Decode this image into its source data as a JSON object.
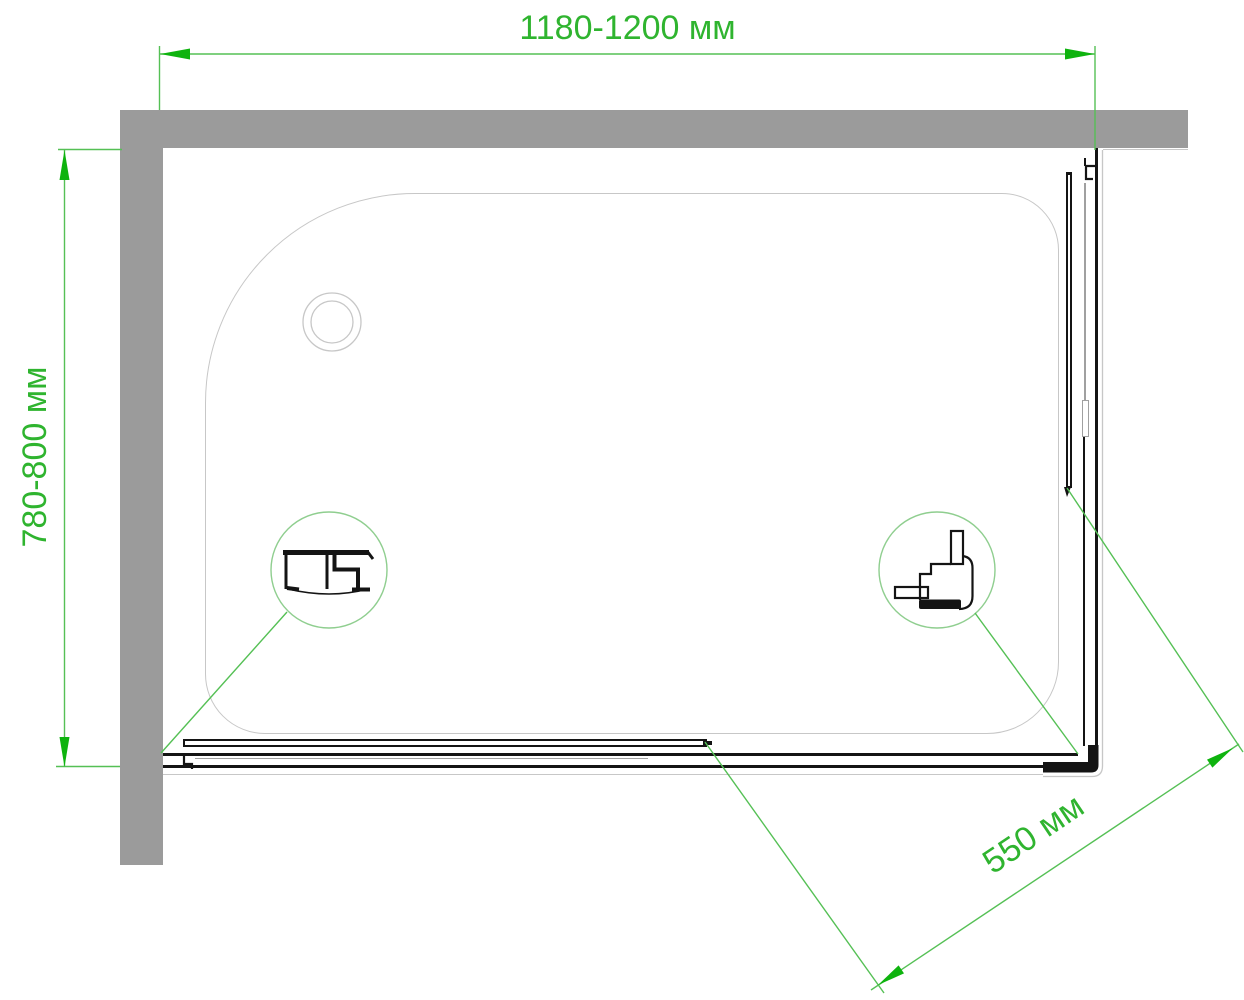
{
  "drawing": {
    "dimensions": {
      "width_top": "1180-1200 мм",
      "depth_left": "780-800 мм",
      "entry_diagonal": "550 мм"
    },
    "colors": {
      "dimension_green": "#2fb42f",
      "line_green": "#55c055",
      "arrow_green": "#0eb30e",
      "circle_green": "#8fce8f",
      "wall_gray": "#9b9b9b",
      "tray_outline": "#c7c7c7",
      "glass_gray": "#a0a0a0",
      "profile_black": "#141414",
      "background": "#ffffff"
    }
  }
}
